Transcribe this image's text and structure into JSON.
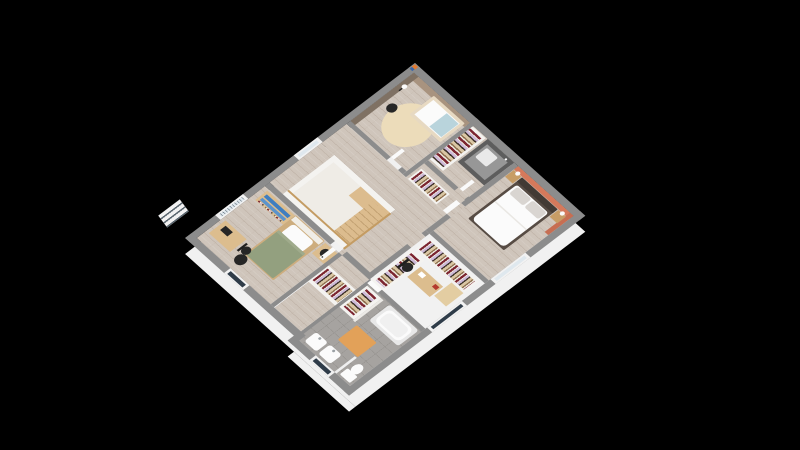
{
  "scene": {
    "type": "3d-floorplan-render",
    "description": "Isometric 3D render of an upper-storey house floor plan on a black background, viewed from the south corner",
    "background": "#000000",
    "palette": {
      "bg": "#000000",
      "wallTop": "#8c8c8c",
      "skirt": "#f1f1f1",
      "woodA": "#cfc5bb",
      "tile": "#a6a3a0",
      "tileLine": "#96938f",
      "voidWhite": "#efece6",
      "voidWall": "#f4f3f0",
      "whiteSoft": "#fbfbfb",
      "taupeLight": "#a8937f",
      "taupeDark": "#7f7163",
      "salmon": "#d5795b",
      "salmonDark": "#c76e52",
      "showerDark": "#5d5d5d",
      "showerMid": "#979797",
      "showerTray": "#e9e9e9",
      "rugBeige": "#ecdcba",
      "crib": "#e7d9c2",
      "cribBlanket": "#b9d4dc",
      "pillowGray": "#d9d5d1",
      "bedFrameDark": "#574c44",
      "headboardDark": "#423a34",
      "headboardLight": "#f0ede6",
      "duvetFold": "#e9e7e3",
      "woodFurn": "#dcbd8e",
      "bedWood": "#cdad7e",
      "woodNight": "#c79d66",
      "cabinetTan": "#e3cda2",
      "greenDuvet": "#93a07f",
      "greenFold": "#a0ab8c",
      "blackItem": "#262626",
      "matOrange": "#e2a159",
      "glassDark": "#2f3c49",
      "glassLight": "#dfe8ee",
      "stairWood": "#dcbc8e",
      "stairLine": "#c3a273",
      "rail": "#c49c63",
      "shelfBlue": "#3f7ec0",
      "shelfBlue2": "#5b93cc",
      "clothes1": "#7c2531",
      "clothes2": "#cdb9d8",
      "clothes3": "#d9c6a3",
      "clothes4": "#3f332b",
      "clothes5": "#ece7dc",
      "clothes6": "#8e6f4e",
      "doorWhite": "#fafafa",
      "frameWhite": "#f2f2f2",
      "balloonOrange": "#e07a30",
      "balloonBlue": "#3c67a8",
      "redItem": "#b33a2e"
    },
    "rooms": [
      {
        "id": "nursery",
        "name": "nursery",
        "wall_accent": "taupe",
        "furniture": [
          "baby-crib",
          "round-beige-rug",
          "floor-lamp",
          "black-pouf",
          "balloon-decor"
        ]
      },
      {
        "id": "shower-room",
        "name": "shower-room",
        "furniture": [
          "shower-enclosure",
          "wardrobe-clothes-rail"
        ]
      },
      {
        "id": "master-bedroom",
        "name": "master-bedroom",
        "wall_accent": "salmon",
        "furniture": [
          "double-bed",
          "two-pillows",
          "nightstand-left",
          "nightstand-right",
          "two-table-lamps",
          "window"
        ]
      },
      {
        "id": "landing",
        "name": "landing-hallway",
        "furniture": [
          "stair-void",
          "wood-staircase",
          "stair-railing",
          "open-wardrobe",
          "window"
        ]
      },
      {
        "id": "office-dressing",
        "name": "office-dressing-room",
        "furniture": [
          "desk",
          "office-chair",
          "red-telephone",
          "l-shaped-wardrobe",
          "tan-cabinet",
          "window"
        ]
      },
      {
        "id": "bedroom-2",
        "name": "bedroom-2",
        "furniture": [
          "single-bed-green",
          "bookshelf-blue-books",
          "side-table",
          "black-stool",
          "desk",
          "desk-chair",
          "black-round-rug",
          "window",
          "door"
        ]
      },
      {
        "id": "bathroom",
        "name": "bathroom",
        "floor": "gray-tile",
        "furniture": [
          "bathtub",
          "washbasin-1",
          "washbasin-2",
          "toilet",
          "orange-bath-mat",
          "wardrobe-nook",
          "window"
        ]
      }
    ]
  }
}
